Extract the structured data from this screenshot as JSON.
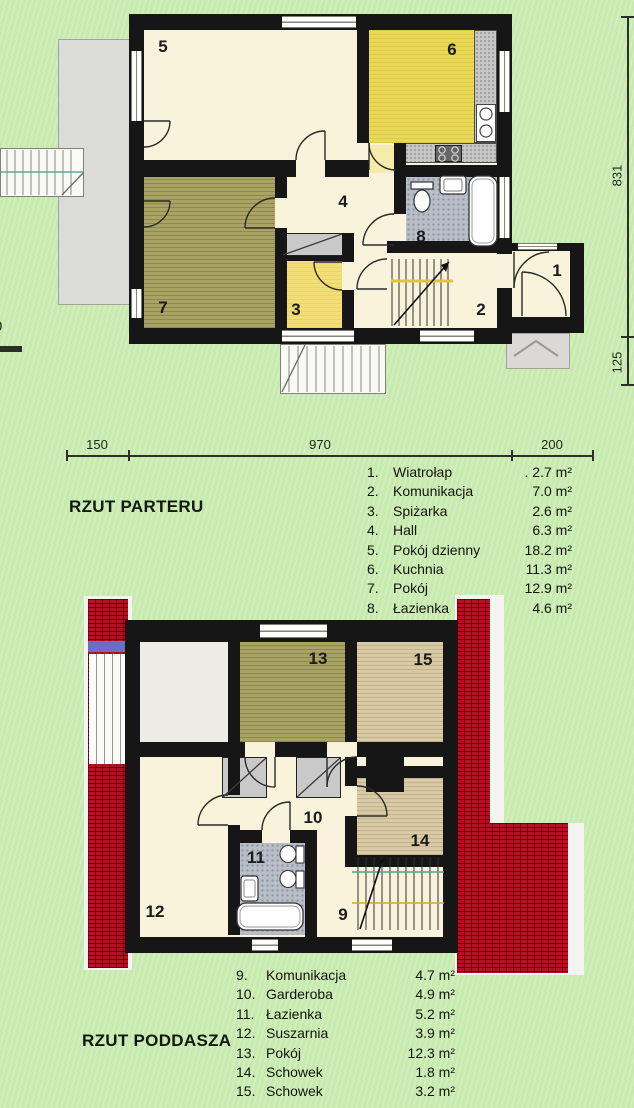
{
  "palette": {
    "background_green": "#cdeeb5",
    "wall_black": "#161616",
    "roof_red": "#b21320",
    "room_cream": "#f8f3da",
    "kitchen_yellow": "#e9d954",
    "pantry_yellow": "#f2de75",
    "room_olive": "#a9a364",
    "room_tan": "#d8caa5",
    "bath_gray": "#b8bdc8",
    "terrace_gray": "#dbdbd7"
  },
  "ground_floor": {
    "title": "RZUT PARTERU",
    "room_labels": {
      "r1": "1",
      "r2": "2",
      "r3": "3",
      "r4": "4",
      "r5": "5",
      "r6": "6",
      "r7": "7",
      "r8": "8"
    },
    "legend": [
      {
        "no": "1.",
        "name": "Wiatrołap",
        "area": ". 2.7 m²"
      },
      {
        "no": "2.",
        "name": "Komunikacja",
        "area": "7.0 m²"
      },
      {
        "no": "3.",
        "name": "Spiżarka",
        "area": "2.6 m²"
      },
      {
        "no": "4.",
        "name": "Hall",
        "area": "6.3 m²"
      },
      {
        "no": "5.",
        "name": "Pokój dzienny",
        "area": "18.2 m²"
      },
      {
        "no": "6.",
        "name": "Kuchnia",
        "area": "11.3 m²"
      },
      {
        "no": "7.",
        "name": "Pokój",
        "area": "12.9 m²"
      },
      {
        "no": "8.",
        "name": "Łazienka",
        "area": "4.6 m²"
      }
    ],
    "dims": {
      "width_left": "150",
      "width_mid": "970",
      "width_right": "200",
      "height_main": "831",
      "height_lower": "125",
      "left_cut_fragment": "0"
    }
  },
  "attic": {
    "title": "RZUT PODDASZA",
    "room_labels": {
      "r9": "9",
      "r10": "10",
      "r11": "11",
      "r12": "12",
      "r13": "13",
      "r14": "14",
      "r15": "15"
    },
    "legend": [
      {
        "no": "9.",
        "name": "Komunikacja",
        "area": "4.7 m²"
      },
      {
        "no": "10.",
        "name": "Garderoba",
        "area": "4.9 m²"
      },
      {
        "no": "11.",
        "name": "Łazienka",
        "area": "5.2 m²"
      },
      {
        "no": "12.",
        "name": "Suszarnia",
        "area": "3.9 m²"
      },
      {
        "no": "13.",
        "name": "Pokój",
        "area": "12.3 m²"
      },
      {
        "no": "14.",
        "name": "Schowek",
        "area": "1.8 m²"
      },
      {
        "no": "15.",
        "name": "Schowek",
        "area": "3.2 m²"
      }
    ]
  }
}
